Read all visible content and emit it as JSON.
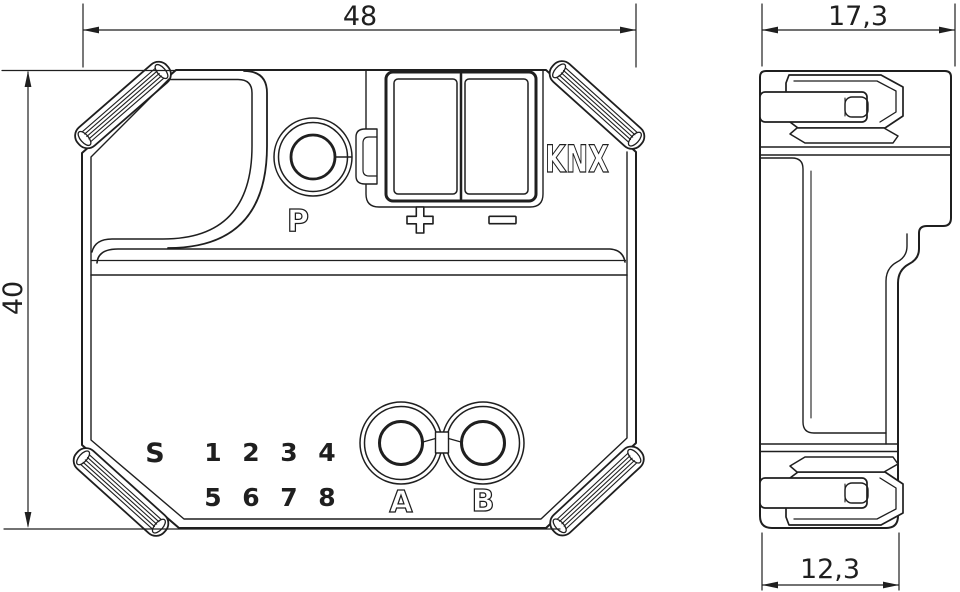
{
  "title": "KNX flush-mounted device dimensional drawing",
  "colors": {
    "line": "#1f1f1f",
    "background": "#ffffff"
  },
  "front_view": {
    "width_dim": "48",
    "height_dim": "40",
    "programming_button_label": "P",
    "bus_label": "KNX",
    "plus_label": "+",
    "minus_label": "−",
    "s_label": "S",
    "channel_row_1": [
      "1",
      "2",
      "3",
      "4"
    ],
    "channel_row_2": [
      "5",
      "6",
      "7",
      "8"
    ],
    "grommet_a_label": "A",
    "grommet_b_label": "B"
  },
  "side_view": {
    "depth_top_dim": "17,3",
    "depth_bottom_dim": "12,3"
  }
}
